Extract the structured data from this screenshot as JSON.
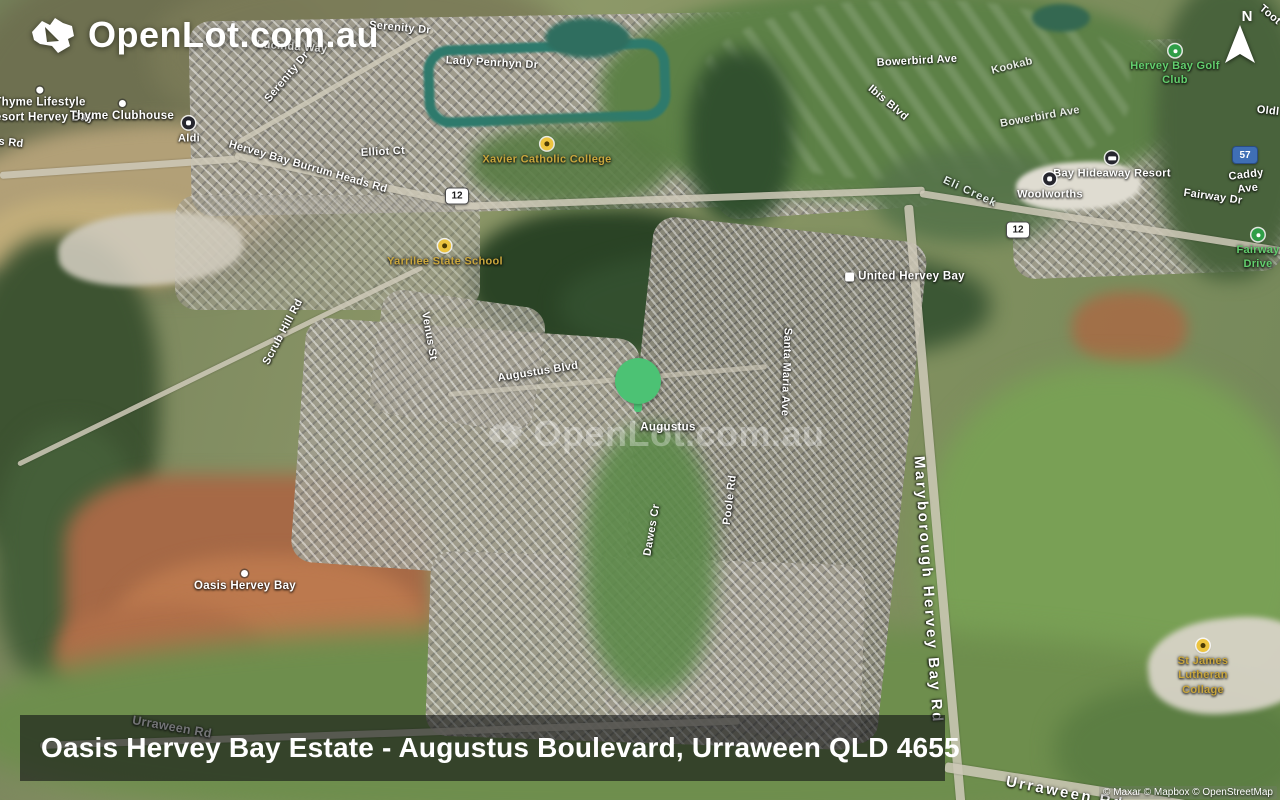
{
  "brand": {
    "logo_text": "OpenLot.com.au"
  },
  "compass": {
    "label": "N"
  },
  "watermark": {
    "text": "OpenLot.com.au"
  },
  "caption": {
    "text": "Oasis Hervey Bay Estate - Augustus Boulevard, Urraween QLD 4655"
  },
  "attribution": {
    "text": "© Maxar © Mapbox © OpenStreetMap"
  },
  "colors": {
    "pin_green": "#4cc274"
  },
  "map": {
    "pin": {
      "x": 638,
      "y": 381
    },
    "shields": [
      {
        "text": "12",
        "x": 457,
        "y": 196,
        "style": "white"
      },
      {
        "text": "12",
        "x": 1018,
        "y": 230,
        "style": "white"
      },
      {
        "text": "57",
        "x": 1245,
        "y": 155,
        "style": "blue"
      }
    ],
    "labels": [
      {
        "name": "serenity-dr-top",
        "text": "Serenity Dr",
        "x": 400,
        "y": 28,
        "rot": 5,
        "type": "road"
      },
      {
        "name": "lucinda-way",
        "text": "Lucinda Way",
        "x": 292,
        "y": 47,
        "rot": 4,
        "type": "road",
        "opacity": 0.8
      },
      {
        "name": "serenity-dr-diag",
        "text": "Serenity Dr",
        "x": 287,
        "y": 77,
        "rot": -50,
        "type": "road"
      },
      {
        "name": "lady-penrhyn-dr",
        "text": "Lady Penrhyn Dr",
        "x": 492,
        "y": 63,
        "rot": 3,
        "type": "road"
      },
      {
        "name": "bowerbird-ave",
        "text": "Bowerbird Ave",
        "x": 917,
        "y": 61,
        "rot": -3,
        "type": "road"
      },
      {
        "name": "kookab-fragment",
        "text": "Kookab",
        "x": 1012,
        "y": 66,
        "rot": -14,
        "type": "road",
        "opacity": 0.85
      },
      {
        "name": "toot-fragment",
        "text": "Toot",
        "x": 1270,
        "y": 15,
        "rot": 40,
        "type": "road"
      },
      {
        "name": "hervey-bay-golf-club",
        "text": "Hervey Bay Golf Club",
        "x": 1175,
        "y": 66,
        "rot": 0,
        "type": "park",
        "icon": "golf"
      },
      {
        "name": "ibis-blvd",
        "text": "Ibis Blvd",
        "x": 888,
        "y": 103,
        "rot": 40,
        "type": "road"
      },
      {
        "name": "bowerbird-ave-2",
        "text": "Bowerbird Ave",
        "x": 1040,
        "y": 117,
        "rot": -10,
        "type": "road",
        "opacity": 0.85
      },
      {
        "name": "old-fragment",
        "text": "Oldl",
        "x": 1268,
        "y": 111,
        "rot": 6,
        "type": "road"
      },
      {
        "name": "thyme-lifestyle-resort",
        "text": "Thyme Lifestyle\nResort Hervey Bay",
        "x": 40,
        "y": 106,
        "rot": 0,
        "type": "place",
        "icon": "dot"
      },
      {
        "name": "thyme-clubhouse",
        "text": "Thyme Clubhouse",
        "x": 122,
        "y": 112,
        "rot": 0,
        "type": "place",
        "icon": "dot"
      },
      {
        "name": "s-rd-fragment",
        "text": "s Rd",
        "x": 11,
        "y": 143,
        "rot": 6,
        "type": "road"
      },
      {
        "name": "aldi",
        "text": "Aldi",
        "x": 189,
        "y": 131,
        "rot": 0,
        "type": "poi",
        "icon": "shop"
      },
      {
        "name": "hervey-bay-burrum-heads-rd",
        "text": "Hervey Bay Burrum Heads Rd",
        "x": 308,
        "y": 167,
        "rot": 16,
        "type": "road"
      },
      {
        "name": "elliot-ct",
        "text": "Elliot Ct",
        "x": 383,
        "y": 152,
        "rot": -3,
        "type": "road"
      },
      {
        "name": "xavier-catholic-college",
        "text": "Xavier Catholic College",
        "x": 547,
        "y": 152,
        "rot": 0,
        "type": "school",
        "icon": "school"
      },
      {
        "name": "bay-hideaway-resort",
        "text": "Bay Hideaway Resort",
        "x": 1112,
        "y": 166,
        "rot": 0,
        "type": "poi",
        "icon": "lodging"
      },
      {
        "name": "woolworths",
        "text": "Woolworths",
        "x": 1050,
        "y": 187,
        "rot": 0,
        "type": "poi",
        "icon": "shop"
      },
      {
        "name": "caddy-ave",
        "text": "Caddy Ave",
        "x": 1247,
        "y": 182,
        "rot": -7,
        "type": "road"
      },
      {
        "name": "fairway-dr",
        "text": "Fairway Dr",
        "x": 1213,
        "y": 197,
        "rot": 8,
        "type": "road"
      },
      {
        "name": "eli-creek",
        "text": "Eli Creek",
        "x": 970,
        "y": 192,
        "rot": 25,
        "type": "water"
      },
      {
        "name": "fairway-drive-park",
        "text": "Fairway Drive",
        "x": 1258,
        "y": 250,
        "rot": 0,
        "type": "park",
        "icon": "park"
      },
      {
        "name": "united-hervey-bay",
        "text": "United Hervey Bay",
        "x": 905,
        "y": 277,
        "rot": 0,
        "type": "place",
        "icon": "fuel",
        "icon_side": "left"
      },
      {
        "name": "yarrilee-state-school",
        "text": "Yarrilee State School",
        "x": 445,
        "y": 254,
        "rot": 0,
        "type": "school",
        "icon": "school"
      },
      {
        "name": "scrub-hill-rd",
        "text": "Scrub Hill Rd",
        "x": 283,
        "y": 332,
        "rot": -62,
        "type": "road"
      },
      {
        "name": "venus-st",
        "text": "Venus St",
        "x": 429,
        "y": 336,
        "rot": 80,
        "type": "road"
      },
      {
        "name": "augustus-blvd",
        "text": "Augustus Blvd",
        "x": 538,
        "y": 372,
        "rot": -9,
        "type": "road"
      },
      {
        "name": "santa-maria-ave",
        "text": "Santa Maria Ave",
        "x": 786,
        "y": 372,
        "rot": 92,
        "type": "road"
      },
      {
        "name": "augustus",
        "text": "Augustus",
        "x": 668,
        "y": 428,
        "rot": 0,
        "type": "place"
      },
      {
        "name": "poole-rd",
        "text": "Poole Rd",
        "x": 730,
        "y": 500,
        "rot": -83,
        "type": "road"
      },
      {
        "name": "dawes-cr",
        "text": "Dawes Cr",
        "x": 652,
        "y": 530,
        "rot": -80,
        "type": "road"
      },
      {
        "name": "maryborough-hervey-bay-rd",
        "text": "Maryborough Hervey Bay Rd",
        "x": 928,
        "y": 590,
        "rot": 86,
        "type": "road-big"
      },
      {
        "name": "oasis-hervey-bay",
        "text": "Oasis Hervey Bay",
        "x": 245,
        "y": 582,
        "rot": 0,
        "type": "place",
        "icon": "dot"
      },
      {
        "name": "st-james-lutheran-collage",
        "text": "St James Lutheran\nCollage",
        "x": 1203,
        "y": 668,
        "rot": 0,
        "type": "school",
        "icon": "school"
      },
      {
        "name": "urraween-rd-left",
        "text": "Urraween Rd",
        "x": 172,
        "y": 727,
        "rot": 10,
        "type": "road-mid"
      },
      {
        "name": "urraween-rd-right",
        "text": "Urraween Rd",
        "x": 1065,
        "y": 793,
        "rot": 11,
        "type": "road-big"
      }
    ]
  }
}
